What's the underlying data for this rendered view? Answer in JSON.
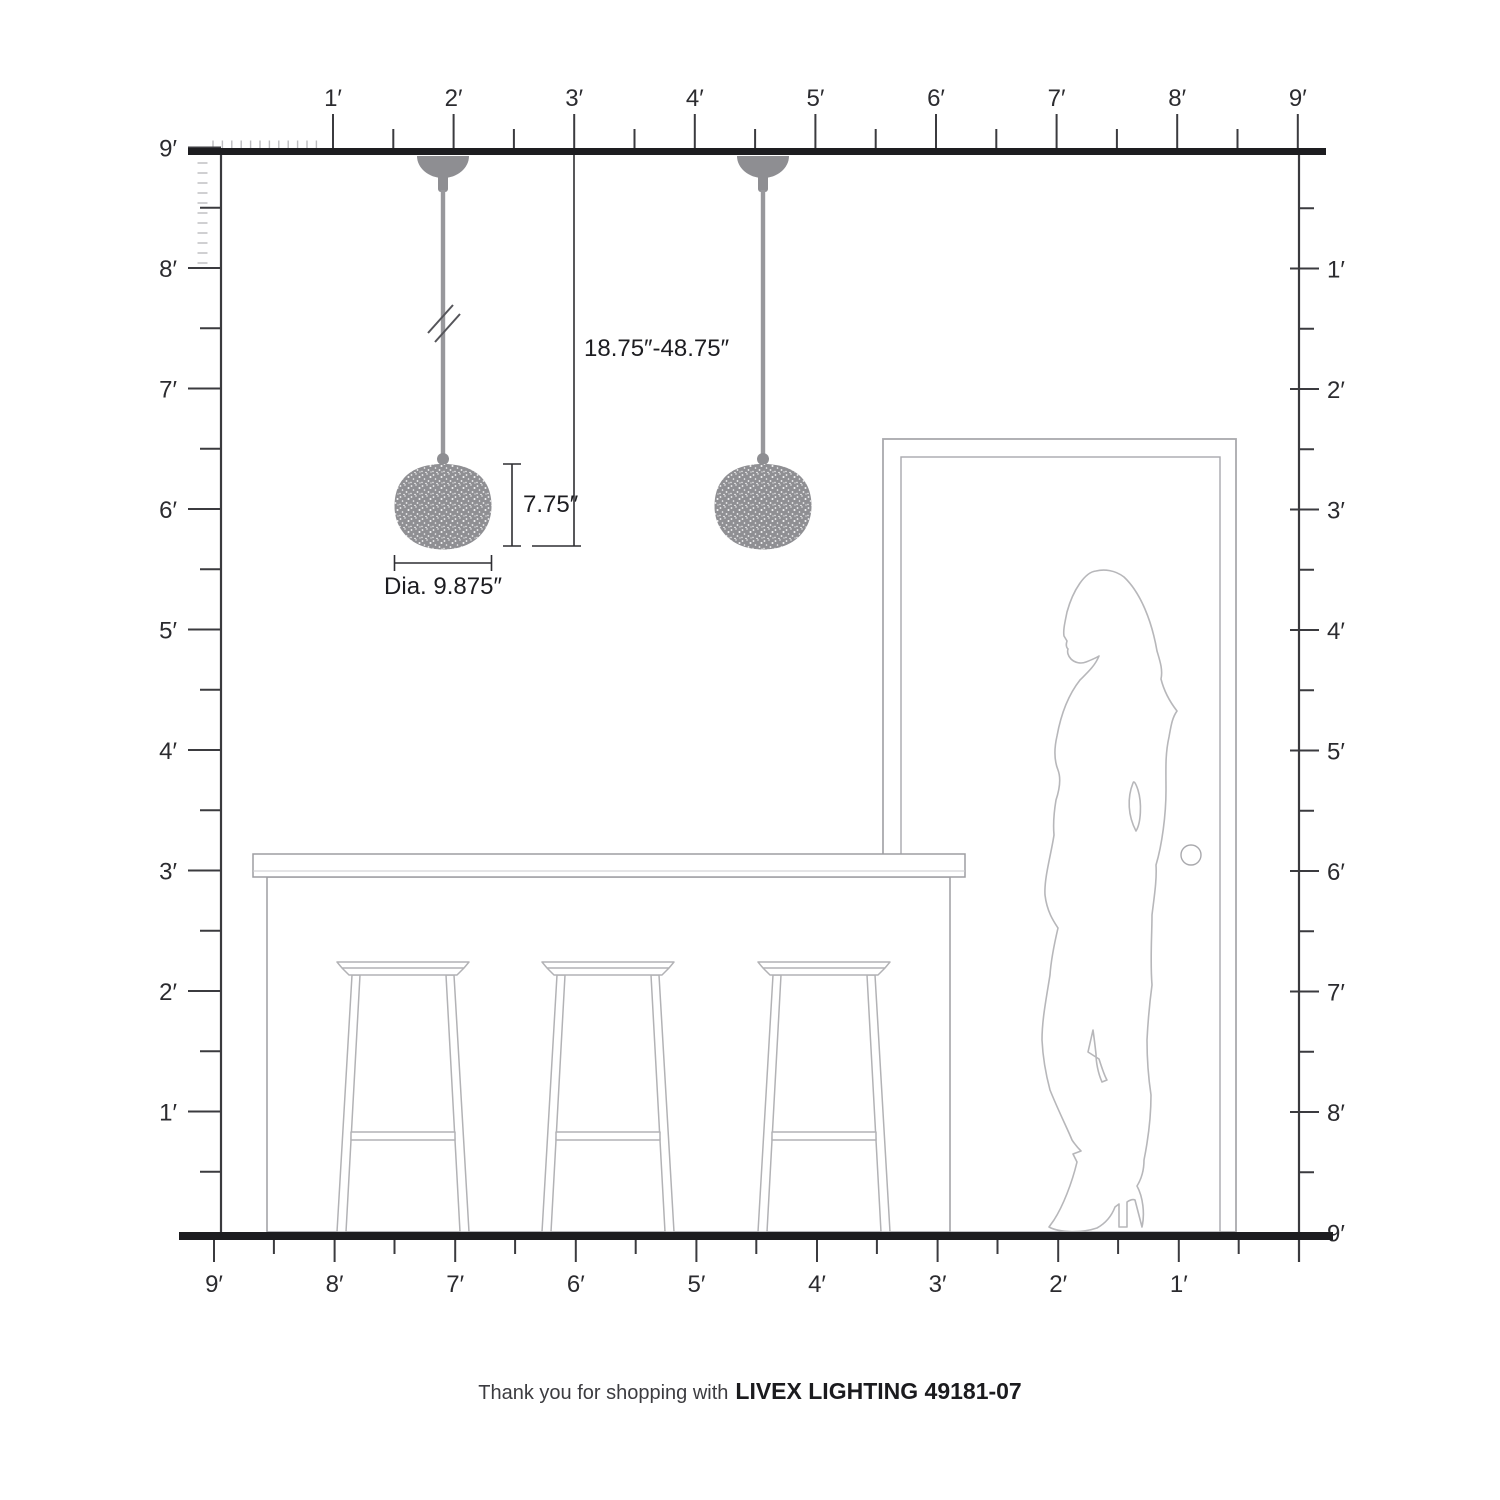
{
  "diagram": {
    "kind": "pendant-light scale elevation",
    "room_height_feet": 9,
    "room_width_feet": 9
  },
  "annotations": {
    "hang_range": "18.75″-48.75″",
    "shade_height": "7.75″",
    "shade_diameter": "Dia. 9.875″"
  },
  "rulers": {
    "top": {
      "labels": [
        "1′",
        "2′",
        "3′",
        "4′",
        "5′",
        "6′",
        "7′",
        "8′",
        "9′"
      ]
    },
    "left": {
      "labels": [
        "9′",
        "8′",
        "7′",
        "6′",
        "5′",
        "4′",
        "3′",
        "2′",
        "1′"
      ]
    },
    "right": {
      "labels": [
        "1′",
        "2′",
        "3′",
        "4′",
        "5′",
        "6′",
        "7′",
        "8′",
        "9′"
      ]
    },
    "bottom": {
      "labels": [
        "9′",
        "8′",
        "7′",
        "6′",
        "5′",
        "4′",
        "3′",
        "2′",
        "1′"
      ]
    }
  },
  "footer": {
    "prefix": "Thank you for shopping with",
    "brand": "LIVEX LIGHTING 49181-07"
  },
  "colors": {
    "structure_line": "#1d1d20",
    "ruler_tick": "#3b3b3f",
    "pendant_gray": "#8e8e92",
    "furniture_outline": "#b2b2b5",
    "dimension_text": "#1d1d21"
  }
}
